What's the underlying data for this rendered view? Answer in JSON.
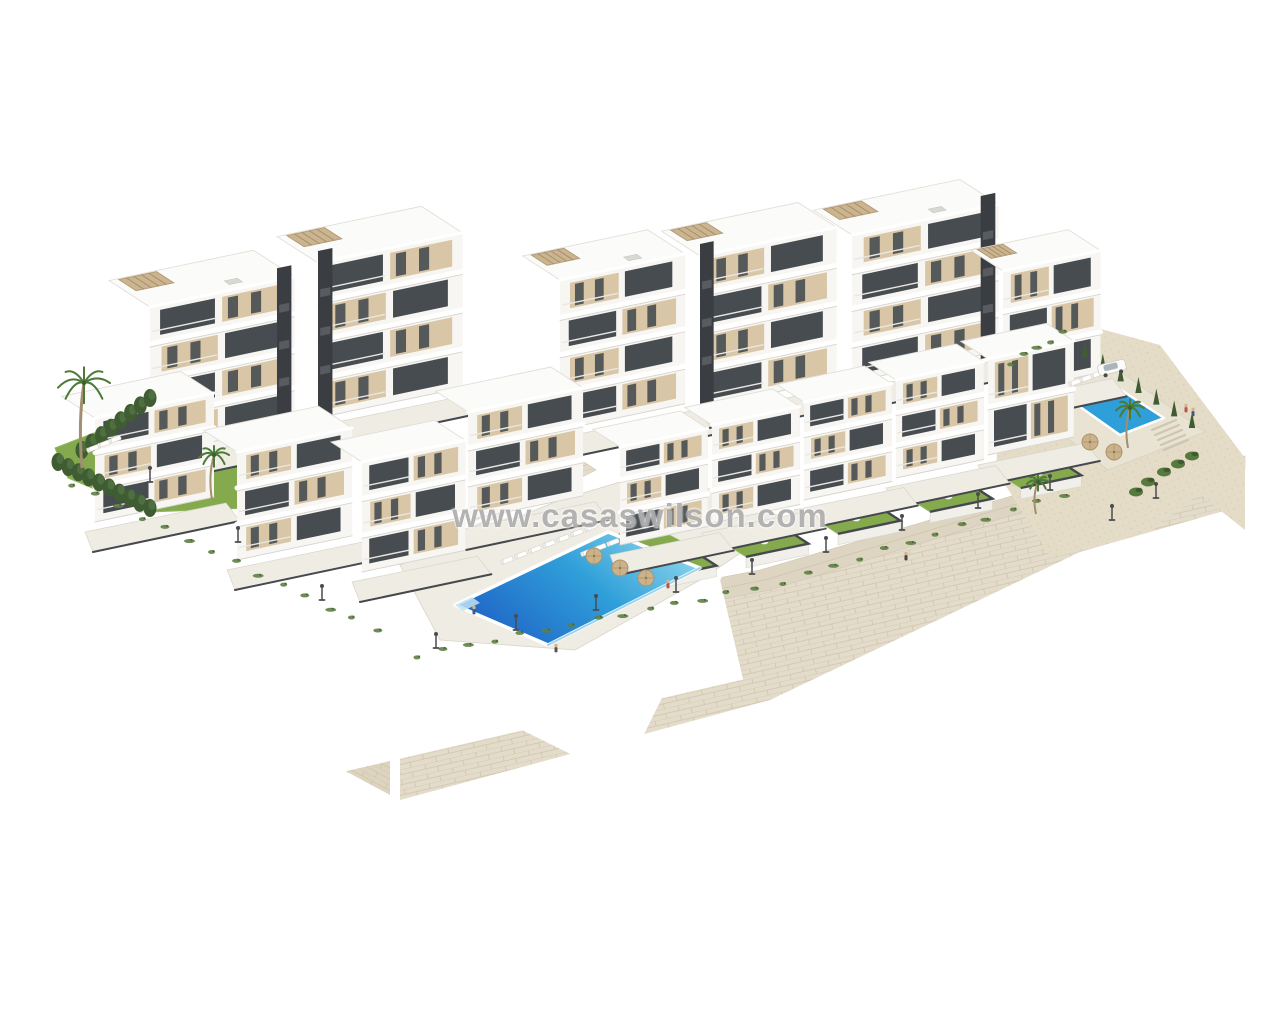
{
  "meta": {
    "type": "3d-architectural-render",
    "description": "Aerial 3D render of a white modern apartment complex on terraced land with stone retaining walls, communal pools, lawns and palm trees on a white background"
  },
  "watermark": {
    "text": "www.casaswilson.com"
  },
  "colors": {
    "background": "#ffffff",
    "facade": "#f7f6f3",
    "facade_shade": "#e6e3dd",
    "roof": "#fbfbf9",
    "window": "#474c51",
    "window_side": "#575c61",
    "panel_beige": "#d8c6a6",
    "core_dark": "#3a3d41",
    "pergola": "#c9b28c",
    "stone_light": "#e4dccb",
    "stone_left": "#ddd4c0",
    "stone_line": "#cfc4ab",
    "sand": "#e4dcc7",
    "lawn": "#84aa4d",
    "lawn_light": "#93b75e",
    "hedge": "#3f5c33",
    "frond": "#4d7a39",
    "trunk": "#a18f6f",
    "pool_deep": "#1f61c6",
    "pool_mid": "#2f9fd9",
    "pool_light": "#8ed7ec",
    "deck": "#efece4",
    "walk": "#ddd5c2",
    "walk_line": "#cdc3ab",
    "lamp": "#4a4c4e",
    "wall_cap": "#45484c",
    "watermark": "rgba(104,104,104,0.5)"
  },
  "scene": {
    "walls": {
      "left": [
        [
          50,
          470
        ],
        [
          200,
          540
        ],
        [
          390,
          638
        ],
        [
          390,
          795
        ],
        [
          50,
          612
        ]
      ],
      "front": [
        [
          400,
          662
        ],
        [
          770,
          590
        ],
        [
          1080,
          494
        ],
        [
          1245,
          468
        ],
        [
          1245,
          505
        ],
        [
          1080,
          552
        ],
        [
          770,
          700
        ],
        [
          400,
          800
        ]
      ],
      "walkway": [
        [
          393,
          640
        ],
        [
          760,
          570
        ],
        [
          1073,
          478
        ],
        [
          1245,
          456
        ],
        [
          1245,
          468
        ],
        [
          1080,
          494
        ],
        [
          770,
          590
        ],
        [
          400,
          662
        ]
      ],
      "corner_column": [
        [
          388,
          634
        ],
        [
          416,
          626
        ],
        [
          416,
          742
        ],
        [
          388,
          754
        ]
      ],
      "corner_cap": [
        [
          384,
          622
        ],
        [
          420,
          612
        ],
        [
          420,
          630
        ],
        [
          384,
          640
        ]
      ]
    },
    "sand": {
      "top": [
        [
          1002,
          360
        ],
        [
          1075,
          322
        ],
        [
          1160,
          345
        ],
        [
          1245,
          458
        ],
        [
          1150,
          532
        ],
        [
          1050,
          556
        ],
        [
          996,
          470
        ]
      ],
      "slope": [
        [
          1075,
          322
        ],
        [
          1245,
          458
        ],
        [
          1245,
          530
        ],
        [
          1075,
          395
        ]
      ]
    },
    "decks": {
      "pool_deck": [
        [
          400,
          565
        ],
        [
          560,
          500
        ],
        [
          660,
          470
        ],
        [
          790,
          520
        ],
        [
          700,
          580
        ],
        [
          575,
          650
        ],
        [
          440,
          640
        ]
      ],
      "right_pool_deck": [
        [
          996,
          382
        ],
        [
          1090,
          350
        ],
        [
          1205,
          432
        ],
        [
          1108,
          470
        ]
      ],
      "stone_feature": [
        [
          497,
          472
        ],
        [
          556,
          444
        ],
        [
          596,
          470
        ],
        [
          537,
          499
        ]
      ]
    },
    "pools": {
      "main": [
        [
          455,
          605
        ],
        [
          608,
          532
        ],
        [
          700,
          568
        ],
        [
          548,
          645
        ]
      ],
      "main_step": [
        [
          455,
          605
        ],
        [
          472,
          597
        ],
        [
          480,
          603
        ],
        [
          463,
          611
        ]
      ],
      "right": [
        [
          1076,
          404
        ],
        [
          1118,
          388
        ],
        [
          1164,
          418
        ],
        [
          1120,
          435
        ]
      ],
      "private": [
        [
          116,
          410
        ],
        [
          150,
          399
        ],
        [
          165,
          411
        ],
        [
          131,
          422
        ]
      ]
    },
    "lawns": {
      "left_garden": [
        [
          55,
          448
        ],
        [
          185,
          398
        ],
        [
          332,
          470
        ],
        [
          300,
          506
        ],
        [
          150,
          512
        ],
        [
          68,
          478
        ]
      ],
      "pool_lawn": [
        [
          596,
          545
        ],
        [
          644,
          522
        ],
        [
          698,
          550
        ],
        [
          650,
          578
        ]
      ]
    },
    "buildings": [
      {
        "p": [
          150,
          455
        ],
        "wa": 148,
        "wb": 66,
        "h": 148,
        "floors": 4,
        "core": "right",
        "pergola": true,
        "ac": true
      },
      {
        "p": [
          318,
          418
        ],
        "wa": 148,
        "wb": 66,
        "h": 155,
        "floors": 4,
        "core": "left",
        "pergola": true,
        "ac": false
      },
      {
        "p": [
          560,
          430
        ],
        "wa": 128,
        "wb": 60,
        "h": 150,
        "floors": 4,
        "core": null,
        "pergola": true,
        "ac": true
      },
      {
        "p": [
          700,
          408
        ],
        "wa": 140,
        "wb": 62,
        "h": 152,
        "floors": 4,
        "core": "left",
        "pergola": true,
        "ac": false
      },
      {
        "p": [
          852,
          382
        ],
        "wa": 150,
        "wb": 62,
        "h": 147,
        "floors": 4,
        "core": "right",
        "pergola": true,
        "ac": true
      },
      {
        "p": [
          1003,
          393
        ],
        "wa": 100,
        "wb": 52,
        "h": 122,
        "floors": 3,
        "core": null,
        "pergola": true,
        "ac": false
      },
      {
        "p": [
          95,
          522
        ],
        "wa": 122,
        "wb": 54,
        "h": 104,
        "floors": 3,
        "core": null,
        "pergola": false,
        "ac": false
      },
      {
        "p": [
          237,
          560
        ],
        "wa": 118,
        "wb": 54,
        "h": 108,
        "floors": 3,
        "core": null,
        "pergola": false,
        "ac": false
      },
      {
        "p": [
          362,
          572
        ],
        "wa": 106,
        "wb": 50,
        "h": 110,
        "floors": 3,
        "core": null,
        "pergola": false,
        "ac": false
      },
      {
        "p": [
          468,
          520
        ],
        "wa": 118,
        "wb": 52,
        "h": 108,
        "floors": 3,
        "core": null,
        "pergola": false,
        "ac": false
      },
      {
        "p": [
          620,
          545
        ],
        "wa": 90,
        "wb": 44,
        "h": 98,
        "floors": 3,
        "core": null,
        "pergola": false,
        "ac": false
      },
      {
        "p": [
          712,
          523
        ],
        "wa": 90,
        "wb": 44,
        "h": 98,
        "floors": 3,
        "core": null,
        "pergola": false,
        "ac": false
      },
      {
        "p": [
          804,
          500
        ],
        "wa": 90,
        "wb": 44,
        "h": 98,
        "floors": 3,
        "core": null,
        "pergola": false,
        "ac": false
      },
      {
        "p": [
          896,
          478
        ],
        "wa": 90,
        "wb": 44,
        "h": 98,
        "floors": 3,
        "core": null,
        "pergola": false,
        "ac": false
      },
      {
        "p": [
          988,
          455
        ],
        "wa": 88,
        "wb": 44,
        "h": 96,
        "floors": 2,
        "core": null,
        "pergola": false,
        "ac": false
      }
    ],
    "gardens": [
      {
        "q": [
          628,
          562
        ],
        "a": 64,
        "b": 42
      },
      {
        "q": [
          720,
          540
        ],
        "a": 64,
        "b": 42
      },
      {
        "q": [
          812,
          517
        ],
        "a": 64,
        "b": 42
      },
      {
        "q": [
          904,
          495
        ],
        "a": 64,
        "b": 42
      },
      {
        "q": [
          996,
          472
        ],
        "a": 62,
        "b": 40
      }
    ],
    "pergola_private": [
      [
        148,
        452
      ],
      [
        208,
        428
      ],
      [
        236,
        446
      ],
      [
        176,
        470
      ]
    ],
    "hedges": [
      {
        "p1": [
          58,
          462
        ],
        "p2": [
          150,
          508
        ],
        "n": 10
      },
      {
        "p1": [
          82,
          450
        ],
        "p2": [
          150,
          398
        ],
        "n": 8
      }
    ],
    "tuft_rows": [
      {
        "p1": [
          60,
          478
        ],
        "p2": [
          388,
          636
        ],
        "n": 14
      },
      {
        "p1": [
          404,
          658
        ],
        "p2": [
          766,
          586
        ],
        "n": 14
      },
      {
        "p1": [
          770,
          586
        ],
        "p2": [
          1076,
          490
        ],
        "n": 12
      },
      {
        "p1": [
          1004,
          366
        ],
        "p2": [
          1070,
          330
        ],
        "n": 5
      }
    ],
    "cypresses": {
      "p1": [
        1085,
        358
      ],
      "p2": [
        1192,
        428
      ],
      "n": 7
    },
    "shrubs": [
      [
        1148,
        482
      ],
      [
        1164,
        472
      ],
      [
        1136,
        492
      ],
      [
        1178,
        464
      ],
      [
        1192,
        456
      ]
    ],
    "palms": [
      {
        "x": 82,
        "y": 468,
        "h": 85,
        "r": 26
      },
      {
        "x": 212,
        "y": 500,
        "h": 45,
        "r": 15
      },
      {
        "x": 1128,
        "y": 448,
        "h": 40,
        "r": 14
      },
      {
        "x": 1036,
        "y": 514,
        "h": 32,
        "r": 11
      }
    ],
    "lounger_rows": [
      {
        "start": [
          508,
          560
        ],
        "step": [
          14,
          -5.5
        ],
        "n": 7,
        "angle": -21
      },
      {
        "start": [
          588,
          552
        ],
        "step": [
          13,
          -5
        ],
        "n": 3,
        "angle": -21
      },
      {
        "start": [
          1076,
          382
        ],
        "step": [
          11,
          -4
        ],
        "n": 4,
        "angle": -20
      },
      {
        "start": [
          94,
          448
        ],
        "step": [
          11,
          -4.5
        ],
        "n": 3,
        "angle": -21
      }
    ],
    "parasols": [
      [
        594,
        556
      ],
      [
        620,
        568
      ],
      [
        646,
        578
      ],
      [
        1090,
        442
      ],
      [
        1114,
        452
      ]
    ],
    "lamps": [
      [
        436,
        648
      ],
      [
        516,
        630
      ],
      [
        596,
        610
      ],
      [
        676,
        592
      ],
      [
        752,
        574
      ],
      [
        826,
        552
      ],
      [
        902,
        530
      ],
      [
        978,
        508
      ],
      [
        1050,
        490
      ],
      [
        150,
        482
      ],
      [
        238,
        542
      ],
      [
        322,
        600
      ],
      [
        1112,
        520
      ],
      [
        1156,
        498
      ]
    ],
    "people": [
      {
        "x": 474,
        "y": 614,
        "c": "#3d5a86"
      },
      {
        "x": 668,
        "y": 588,
        "c": "#b5554e"
      },
      {
        "x": 906,
        "y": 560,
        "c": "#444444"
      },
      {
        "x": 1186,
        "y": 412,
        "c": "#c0504d"
      },
      {
        "x": 1193,
        "y": 416,
        "c": "#3d5a86"
      },
      {
        "x": 556,
        "y": 652,
        "c": "#555555"
      }
    ],
    "steps_right": {
      "start": [
        1152,
        430
      ],
      "n": 5
    },
    "stairs_left": {
      "start": [
        462,
        512
      ],
      "n": 6
    },
    "car": {
      "x": 1112,
      "y": 368,
      "angle": -14
    }
  }
}
